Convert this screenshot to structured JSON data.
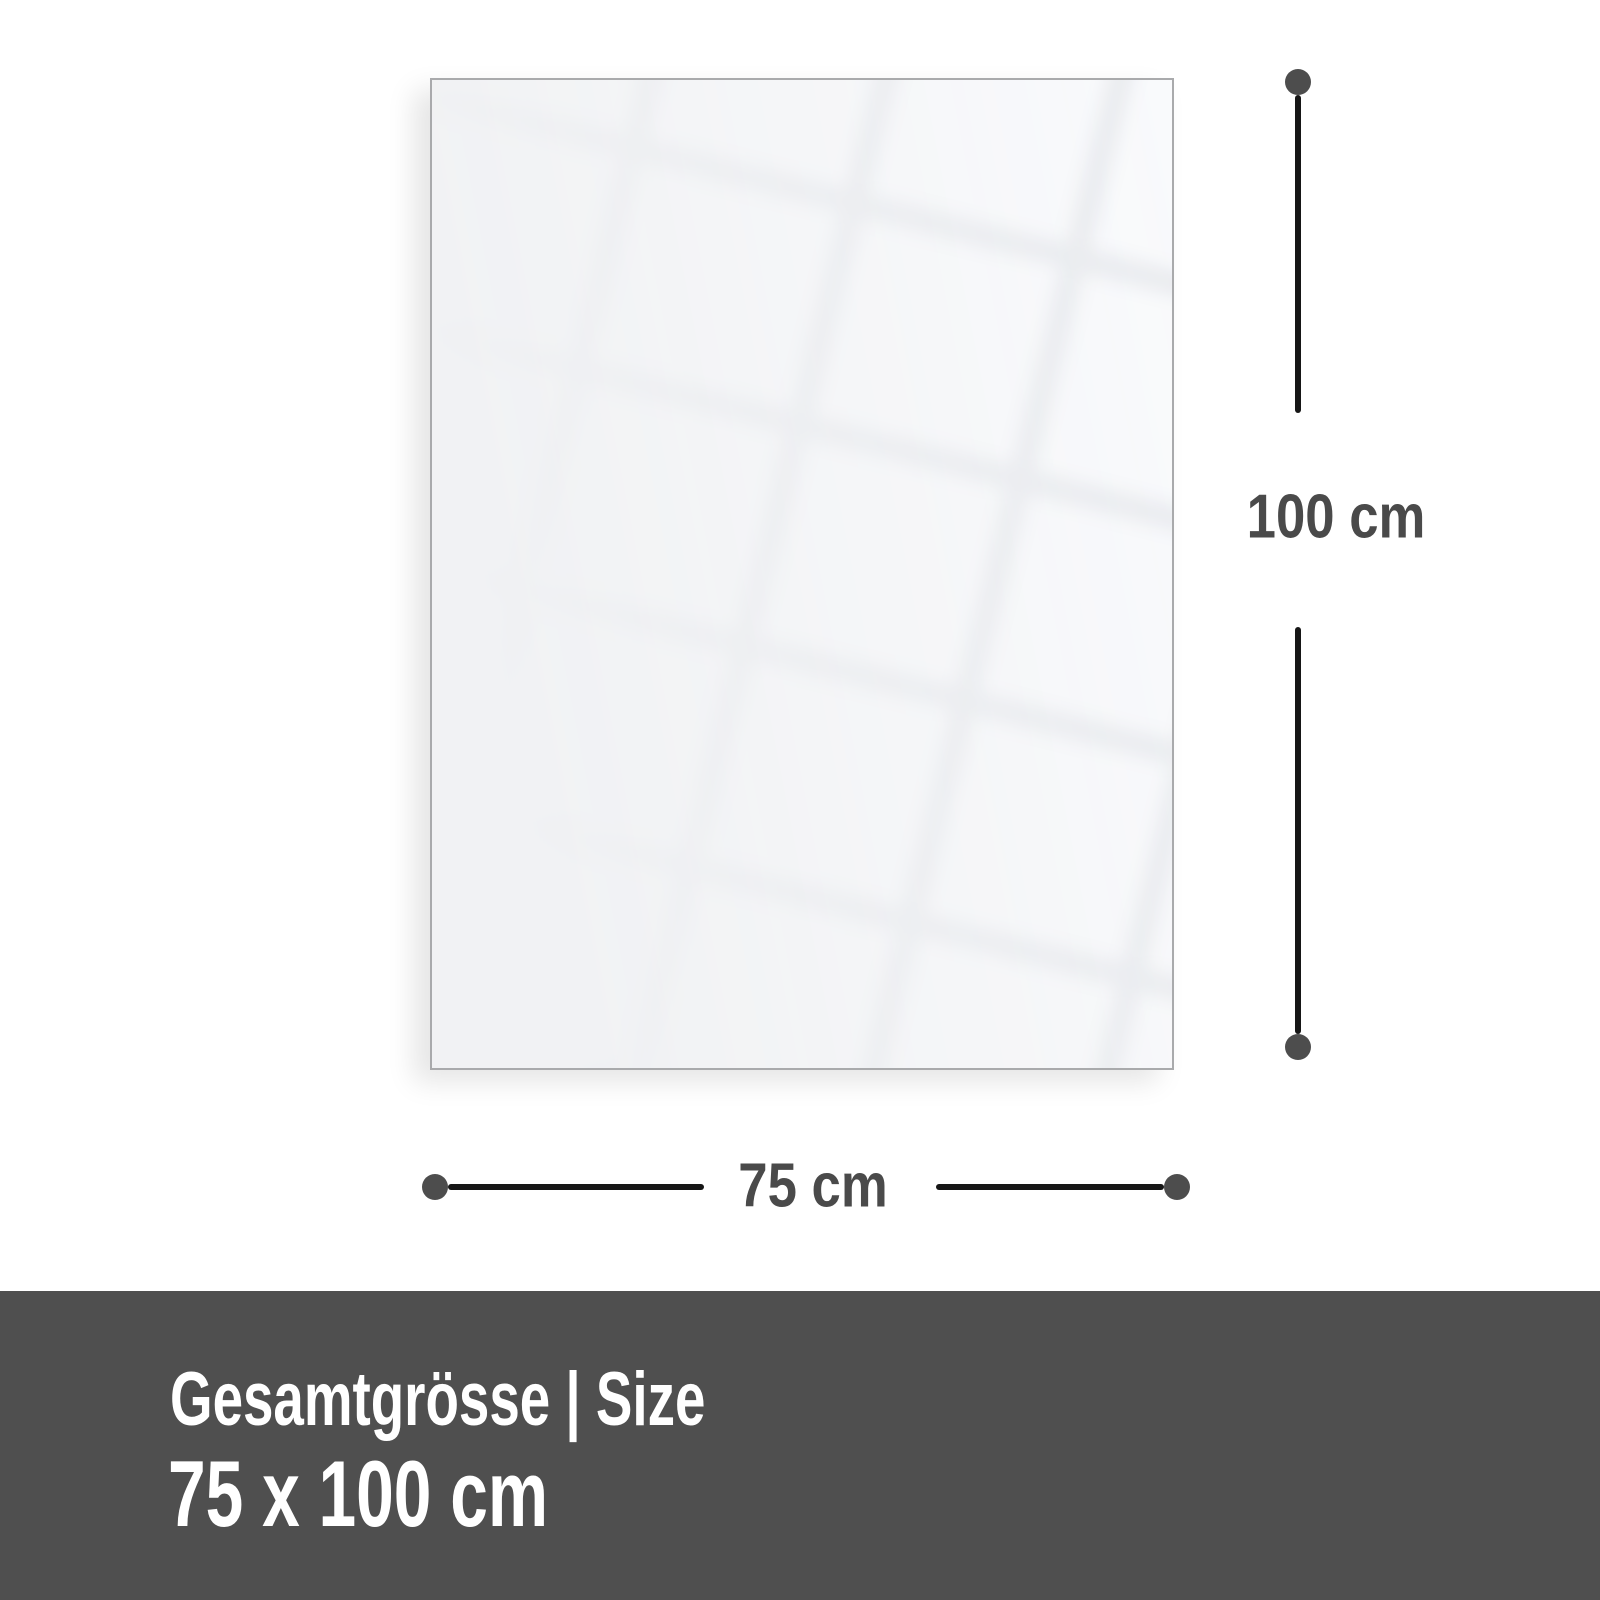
{
  "diagram": {
    "height_label": "100 cm",
    "width_label": "75 cm"
  },
  "footer": {
    "title": "Gesamtgrösse | Size",
    "size_value": "75 x 100 cm"
  },
  "colors": {
    "background": "#ffffff",
    "panel_fill": "#f1f2f4",
    "panel_border": "#a9aaac",
    "dimension_line": "#161616",
    "dimension_dot": "#4d4d4d",
    "dimension_label": "#4a4a4a",
    "footer_background": "#4f4f4f",
    "footer_text": "#ffffff"
  }
}
